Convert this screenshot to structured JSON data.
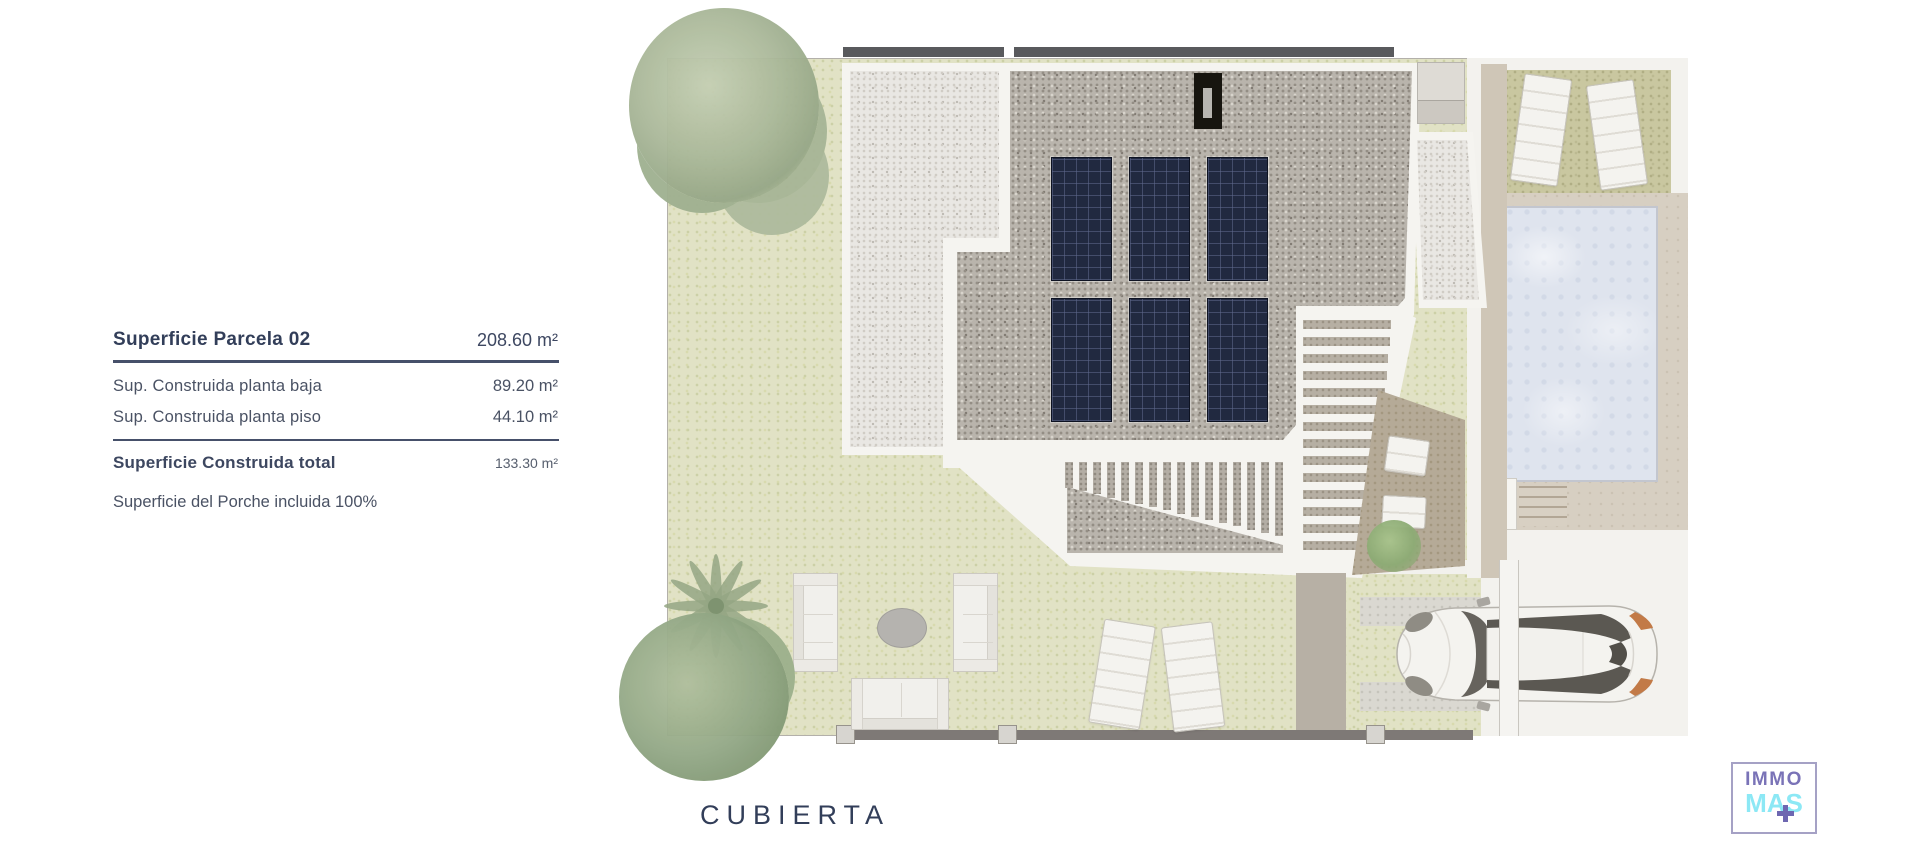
{
  "info_panel": {
    "title": {
      "label": "Superficie Parcela 02",
      "value": "208.60 m²"
    },
    "rows": [
      {
        "label": "Sup. Construida planta baja",
        "value": "89.20 m²"
      },
      {
        "label": "Sup. Construida planta piso",
        "value": "44.10 m²"
      }
    ],
    "total": {
      "label": "Superficie Construida total",
      "value": "133.30 m²"
    },
    "note": "Superficie del Porche incluida 100%"
  },
  "plan": {
    "caption": "CUBIERTA"
  },
  "logo": {
    "top": "IMMO",
    "bottom": "MAS"
  },
  "colors": {
    "text_navy": "#323e59",
    "text_gray": "#4a5264",
    "logo_purple": "#7a73b7",
    "logo_cyan": "#8ce8f5",
    "grass": "#e1e2c5",
    "grass_olive": "#c9c7a0",
    "gravel_light": "#e9e7e3",
    "gravel_dark": "#b9b4ac",
    "pool_water": "#dfe4ee",
    "deck_beige": "#d7cfc2",
    "panel_navy": "#212940",
    "fence_gray": "#7e7976"
  }
}
